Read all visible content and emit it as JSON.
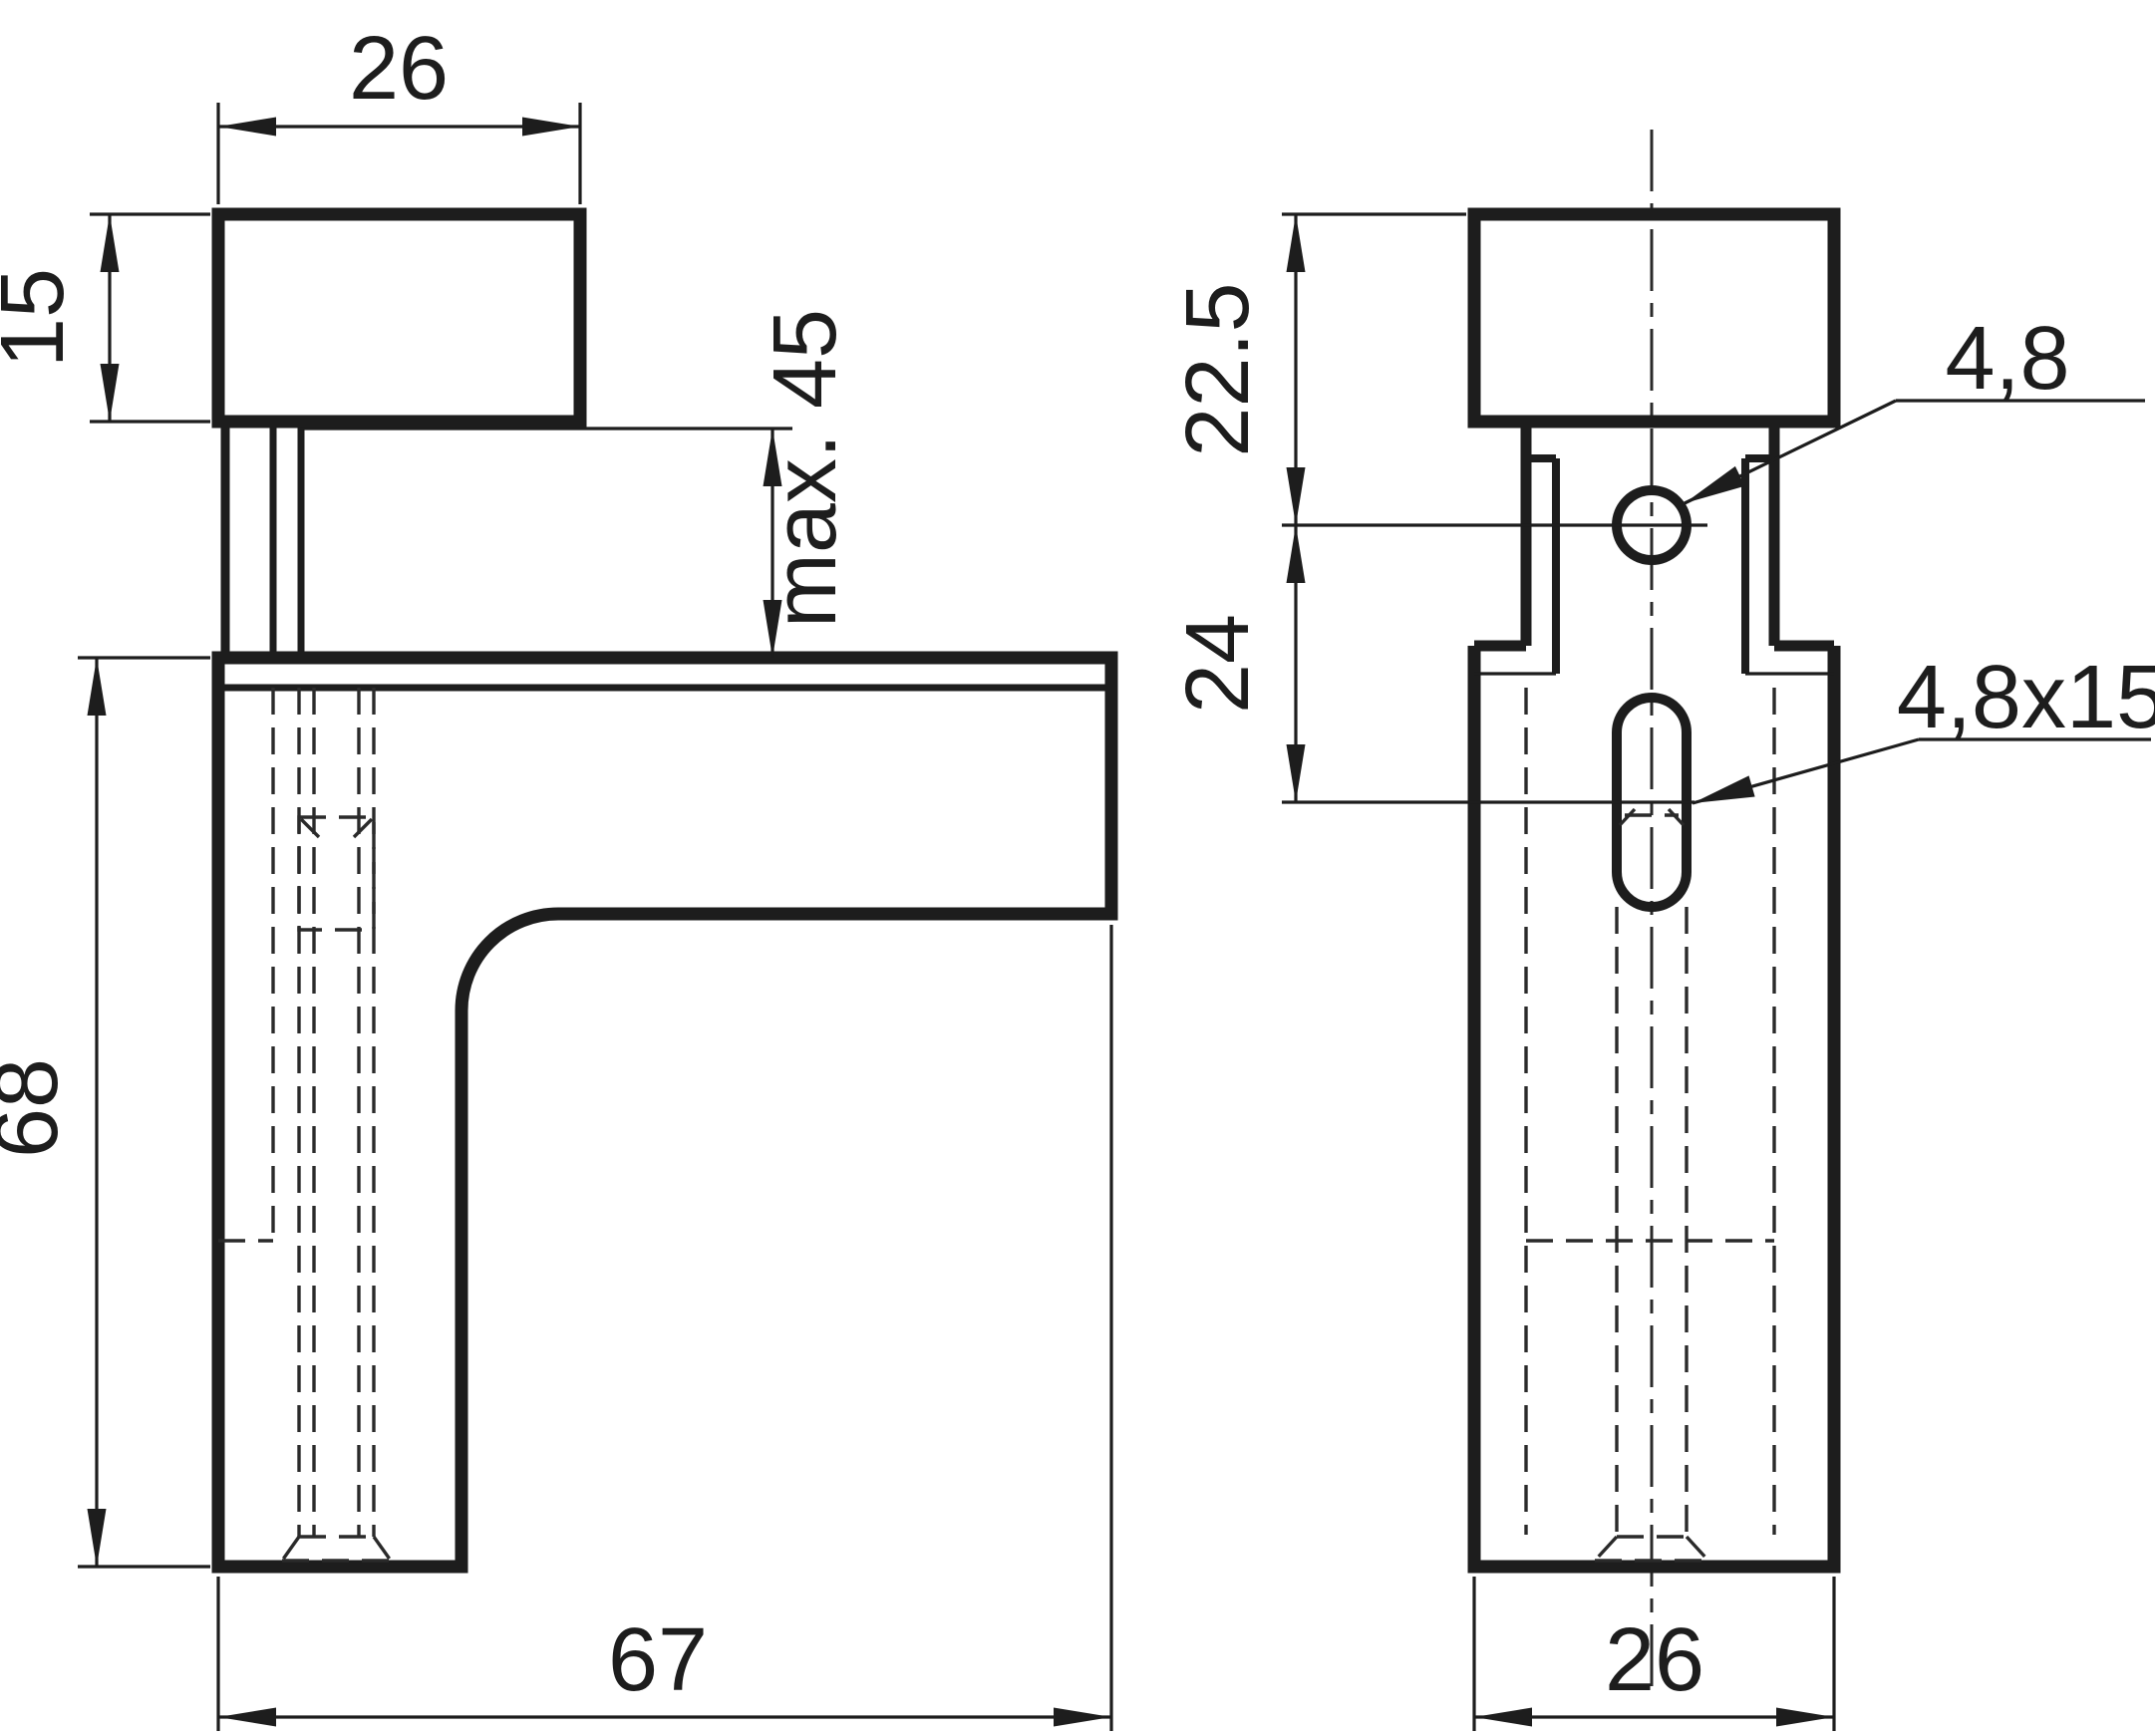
{
  "drawing": {
    "kind": "technical drawing - adjustable shelf support bracket, two orthographic views",
    "colors": {
      "ink": "#1d1d1d",
      "paper": "#ffffff"
    },
    "side_view": {
      "label": "side view",
      "dims": {
        "cap_width": "26",
        "cap_height": "15",
        "clamp_range": "max. 45",
        "body_height": "68",
        "arm_length": "67"
      }
    },
    "front_view": {
      "label": "front view",
      "dims": {
        "cap_top_to_hole": "22.5",
        "hole_center_to_slot": "24",
        "hole_diameter": "4,8",
        "slot_size": "4,8x15",
        "body_width": "26"
      }
    }
  }
}
